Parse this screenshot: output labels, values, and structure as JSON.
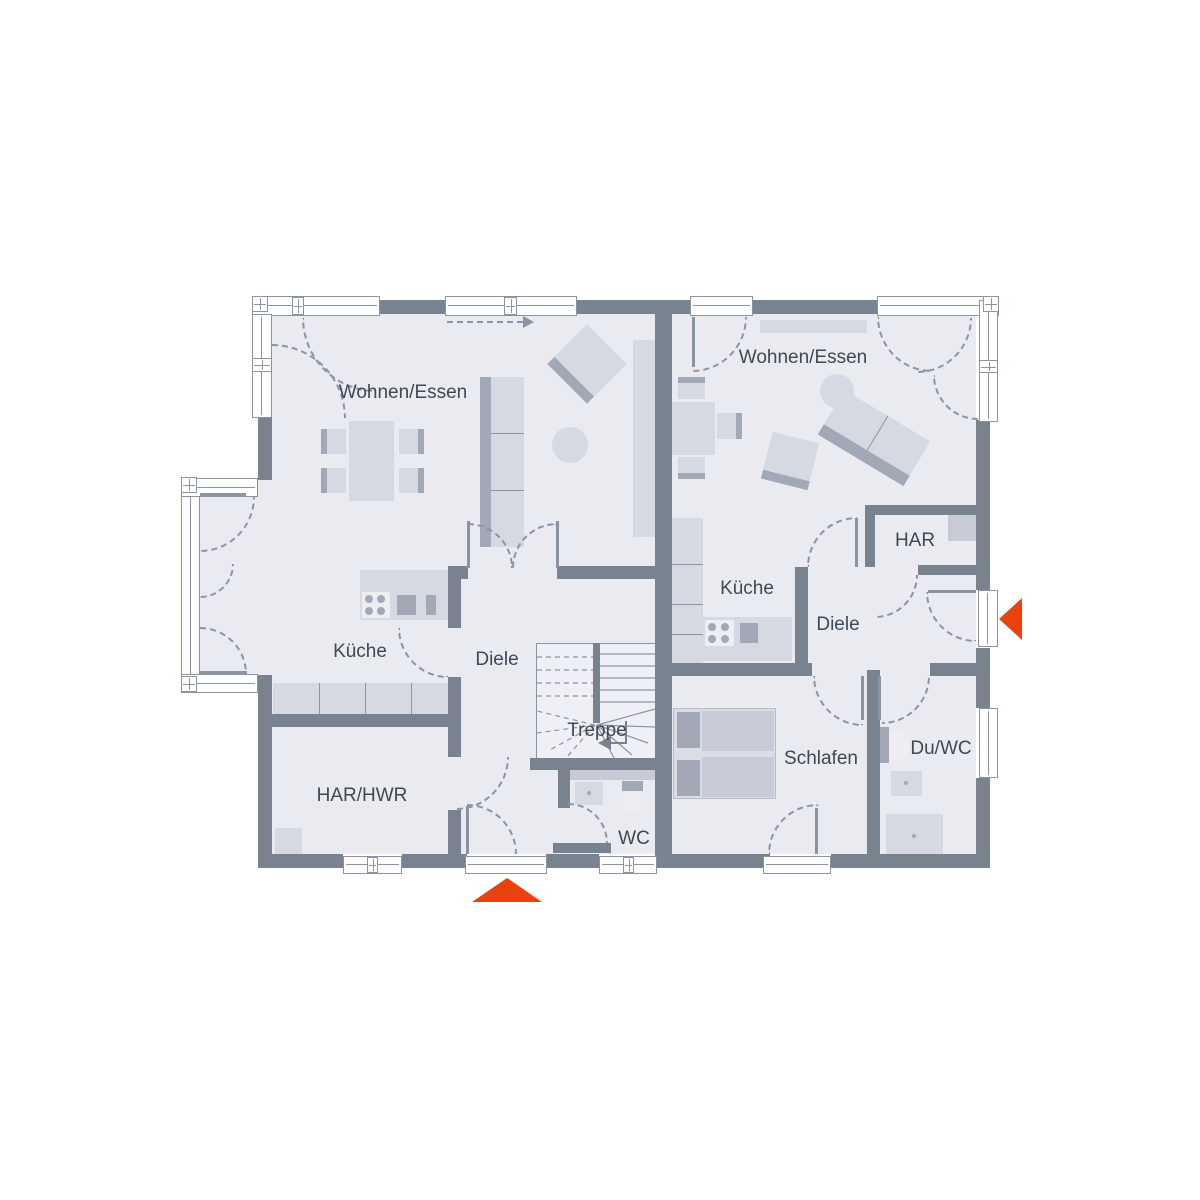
{
  "colors": {
    "wall": "#79828F",
    "floor": "#E9EBF1",
    "line": "#8C94A4",
    "furniture": "#D5D9E2",
    "furniture_mid": "#C7CBD6",
    "furniture_dark": "#A2A8B6",
    "label": "#3E4857",
    "accent": "#E8430F"
  },
  "plan": {
    "unit_left": {
      "wohnen_essen": "Wohnen/Essen",
      "kueche": "Küche",
      "diele": "Diele",
      "treppe": "Treppe",
      "har_hwr": "HAR/HWR",
      "wc": "WC"
    },
    "unit_right": {
      "wohnen_essen": "Wohnen/Essen",
      "kueche": "Küche",
      "diele": "Diele",
      "har": "HAR",
      "schlafen": "Schlafen",
      "du_wc": "Du/WC"
    },
    "icons": {
      "entrance_left_marker": "entrance-triangle-up",
      "entrance_right_marker": "entrance-triangle-left",
      "living_direction_marker": "dashed-arrow-right",
      "stair_direction_marker": "stair-up-arrow"
    }
  }
}
